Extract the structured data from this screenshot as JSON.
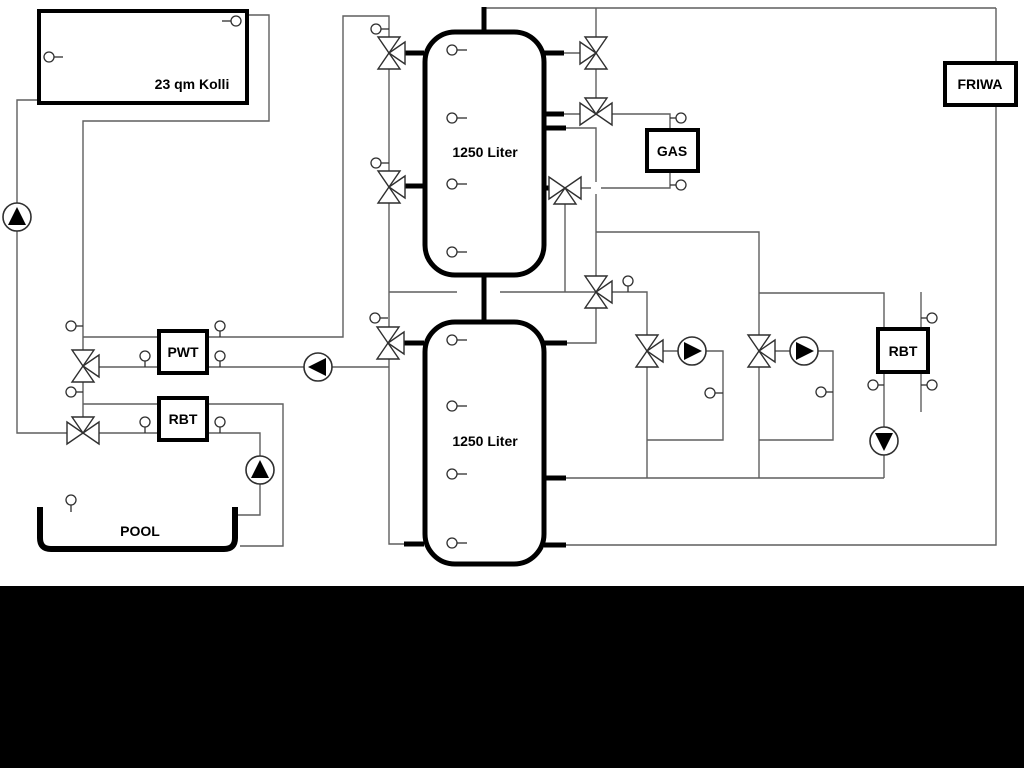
{
  "diagram": {
    "labels": {
      "collector": "23 qm Kolli",
      "tank_upper": "1250 Liter",
      "tank_lower": "1250 Liter",
      "gas": "GAS",
      "friwa": "FRIWA",
      "pwt": "PWT",
      "rbt_left": "RBT",
      "rbt_right": "RBT",
      "pool": "POOL"
    },
    "colors": {
      "background": "#ffffff",
      "pipe_line": "#5f5f5f",
      "component_outline": "#000000",
      "bottom_bar": "#000000"
    }
  }
}
